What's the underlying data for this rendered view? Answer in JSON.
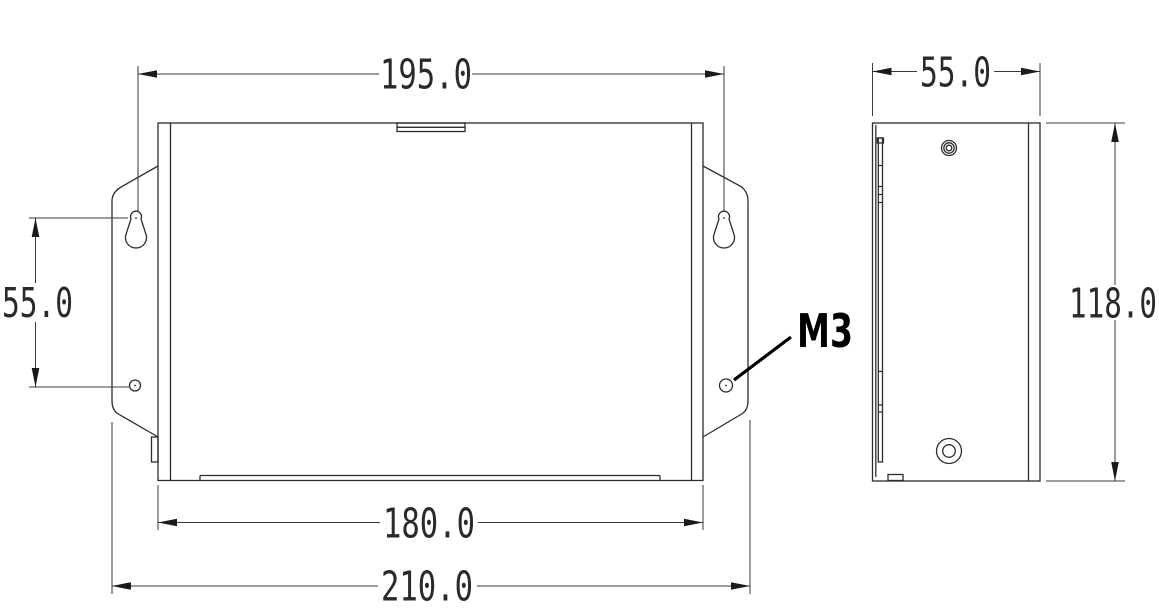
{
  "drawing": {
    "type": "technical-dimension-drawing",
    "unit": "mm",
    "front_view": {
      "dim_mounting_hole_span": "195.0",
      "dim_hole_vertical_spacing": "55.0",
      "dim_body_width": "180.0",
      "dim_overall_width": "210.0",
      "thread_callout": "M3"
    },
    "side_view": {
      "dim_depth": "55.0",
      "dim_height": "118.0"
    },
    "colors": {
      "background": "#ffffff",
      "object_lines": "#2d2d2d",
      "dimension_lines": "#3a3a3a",
      "dimension_text": "#2a2a2a",
      "callout_text": "#000000"
    }
  }
}
